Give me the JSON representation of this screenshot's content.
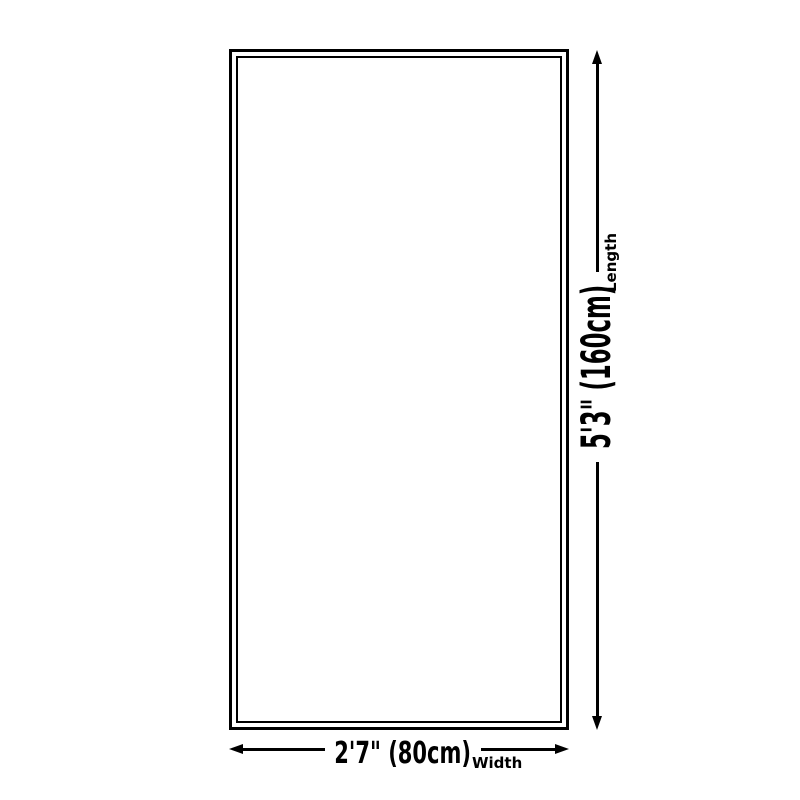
{
  "diagram": {
    "background_color": "#ffffff",
    "line_color": "#000000",
    "rug_fill_color": "#ffffff",
    "dimensions": {
      "length": {
        "value": "5'3\" (160cm)",
        "axis_label": "Length"
      },
      "width": {
        "value": "2'7\" (80cm)",
        "axis_label": "Width"
      }
    }
  }
}
